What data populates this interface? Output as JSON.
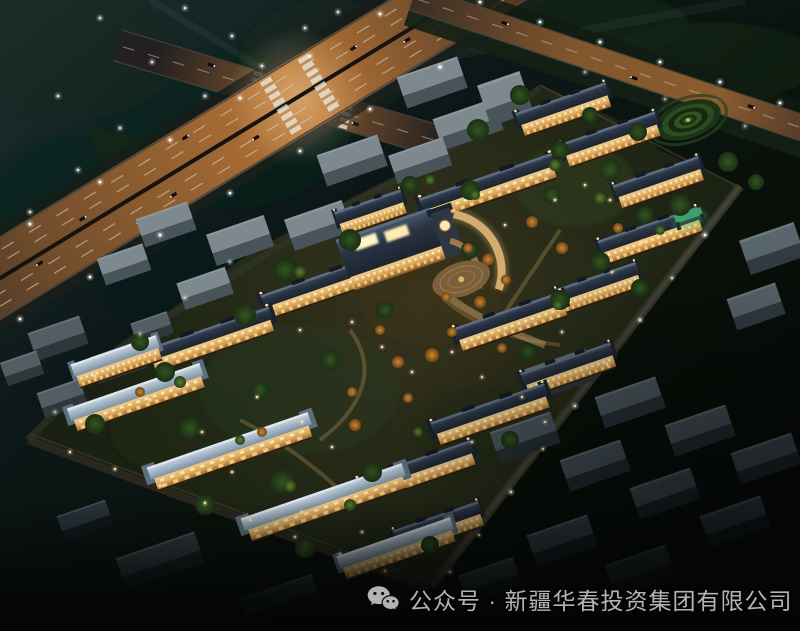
{
  "caption": {
    "icon": "wechat-icon",
    "text": "公众号 · 新疆华春投资集团有限公司"
  },
  "palette": {
    "sky-top": "#1d3032",
    "sky-mid": "#0c1717",
    "ground-dark": "#050806",
    "highway-glow": "#e08c3c",
    "trail-warm": "#ffbf6e",
    "trail-white": "#ffeccb",
    "facade-warm": "#d9a85f",
    "window-glow": "#ffdf9a",
    "roof-dark": "#2a3443",
    "roof-light": "#a4b6c5",
    "tree-dark": "#1a2f15",
    "tree-lit": "#5f7f2e",
    "tree-autumn": "#cd8733",
    "context-gray": "#7d898f",
    "lamp-white": "#ffffff",
    "lamp-amber": "#ffd79a",
    "caption-gray": "#c2c2c0"
  }
}
